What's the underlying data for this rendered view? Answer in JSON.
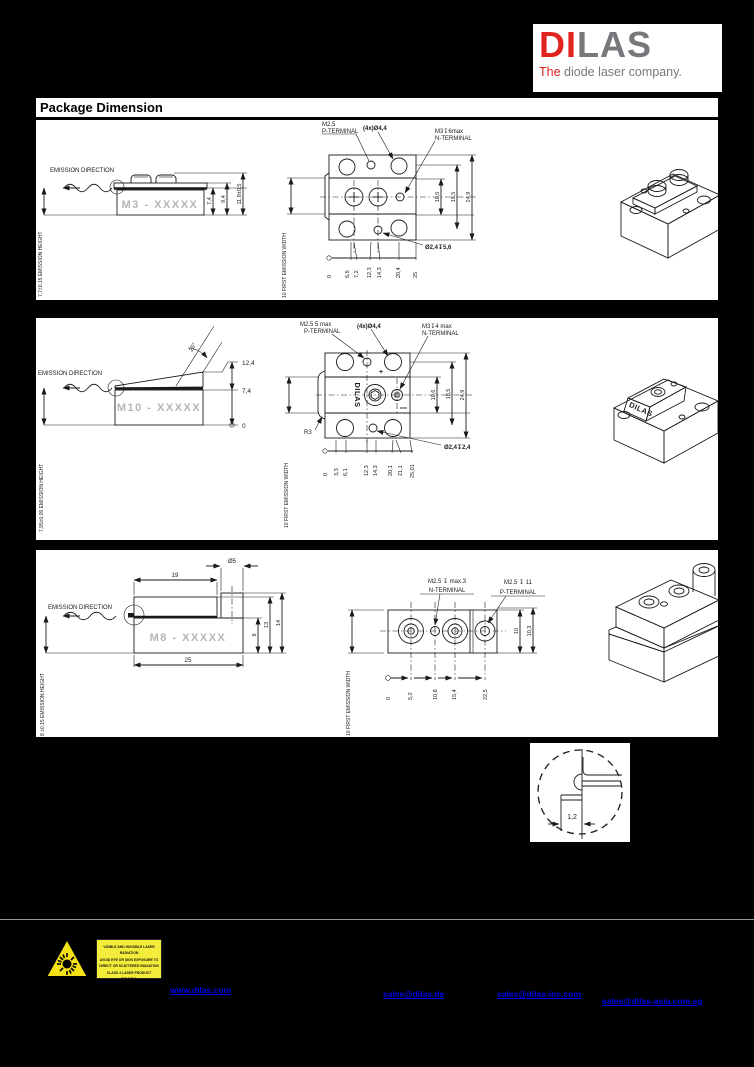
{
  "logo": {
    "di": "DI",
    "las": "LAS",
    "the": "The",
    "tagline": " diode laser company."
  },
  "heading": "Package Dimension",
  "common": {
    "emission_direction": "EMISSION DIRECTION",
    "first_emission_width": "10 FIRST EMISSION WIDTH"
  },
  "sec1": {
    "emission_height": "7,7±0,15 EMISSION HEIGHT",
    "model": "M3 - XXXXX",
    "dim_74": "7,4",
    "dim_94": "9,4",
    "dim_119": "11,9±0,5",
    "p1": "M2.5",
    "p2": "P-TERMINAL",
    "holes": "(4x)Ø4,4",
    "n1": "M3↧6max",
    "n2": "N-TERMINAL",
    "d105": "10,5",
    "d185": "18,5",
    "d249": "24,9",
    "b": [
      "0",
      "6,5",
      "7,2",
      "12,3",
      "14,3",
      "20,4",
      "25"
    ],
    "cbore": "Ø2,4↧5,6"
  },
  "sec2": {
    "emission_height": "7,95±0,05 EMISSION HEIGHT",
    "model": "M10 - XXXXX",
    "angle": "25°",
    "d124": "12,4",
    "d74": "7,4",
    "d0": "0",
    "p1": "M2.5  5 max",
    "p2": "P-TERMINAL",
    "holes": "(4x)Ø4,4",
    "n1": "M3↧4 max",
    "n2": "N-TERMINAL",
    "brand": "DILAS",
    "r3": "R3",
    "plus": "+",
    "d106": "10,6",
    "d185": "18,5",
    "d249": "24,9",
    "b": [
      "0",
      "3,3",
      "6,1",
      "12,3",
      "14,3",
      "20,1",
      "21,1",
      "25,01"
    ],
    "cbore": "Ø2,4↧2,4"
  },
  "sec3": {
    "emission_height": "8 ±0,15 EMISSION HEIGHT",
    "model": "M8 - XXXXX",
    "d19": "19",
    "dd5": "Ø5",
    "d8": "8",
    "d13": "13",
    "d14": "14",
    "d25": "25",
    "n1": "M2.5 ↧ max.3",
    "n2": "N-TERMINAL",
    "p1": "M2.5 ↧ 11",
    "p2": "P-TERMINAL",
    "d10": "10",
    "d103": "10,3",
    "b": [
      "0",
      "5,2",
      "10,8",
      "15,4",
      "22,5"
    ]
  },
  "detail": {
    "dim": "1,2"
  },
  "footer": {
    "warning_lines": [
      "VISIBLE AND INVISIBLE LASER RADIATION",
      "AVOID EYE OR SKIN EXPOSURE TO",
      "DIRECT OR SCATTERED RADIATION",
      "CLASS 4 LASER PRODUCT",
      "IEC 825-1"
    ],
    "links": [
      "www.dilas.com",
      "sales@dilas.de",
      "sales@dilas-inc.com",
      "sales@dilas-asia.com.sg"
    ]
  }
}
